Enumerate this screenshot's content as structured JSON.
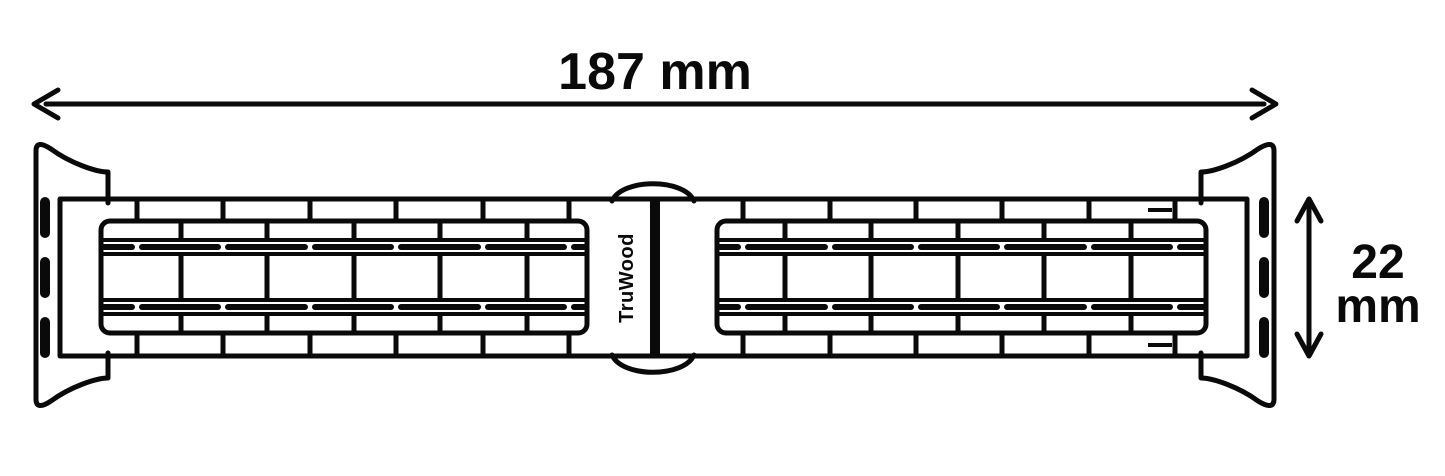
{
  "dimensions": {
    "length": {
      "label": "187 mm"
    },
    "width": {
      "value": "22",
      "unit": "mm"
    }
  },
  "brand": {
    "name": "TruWood"
  },
  "colors": {
    "ink": "#0a0a0a",
    "background": "#ffffff"
  }
}
